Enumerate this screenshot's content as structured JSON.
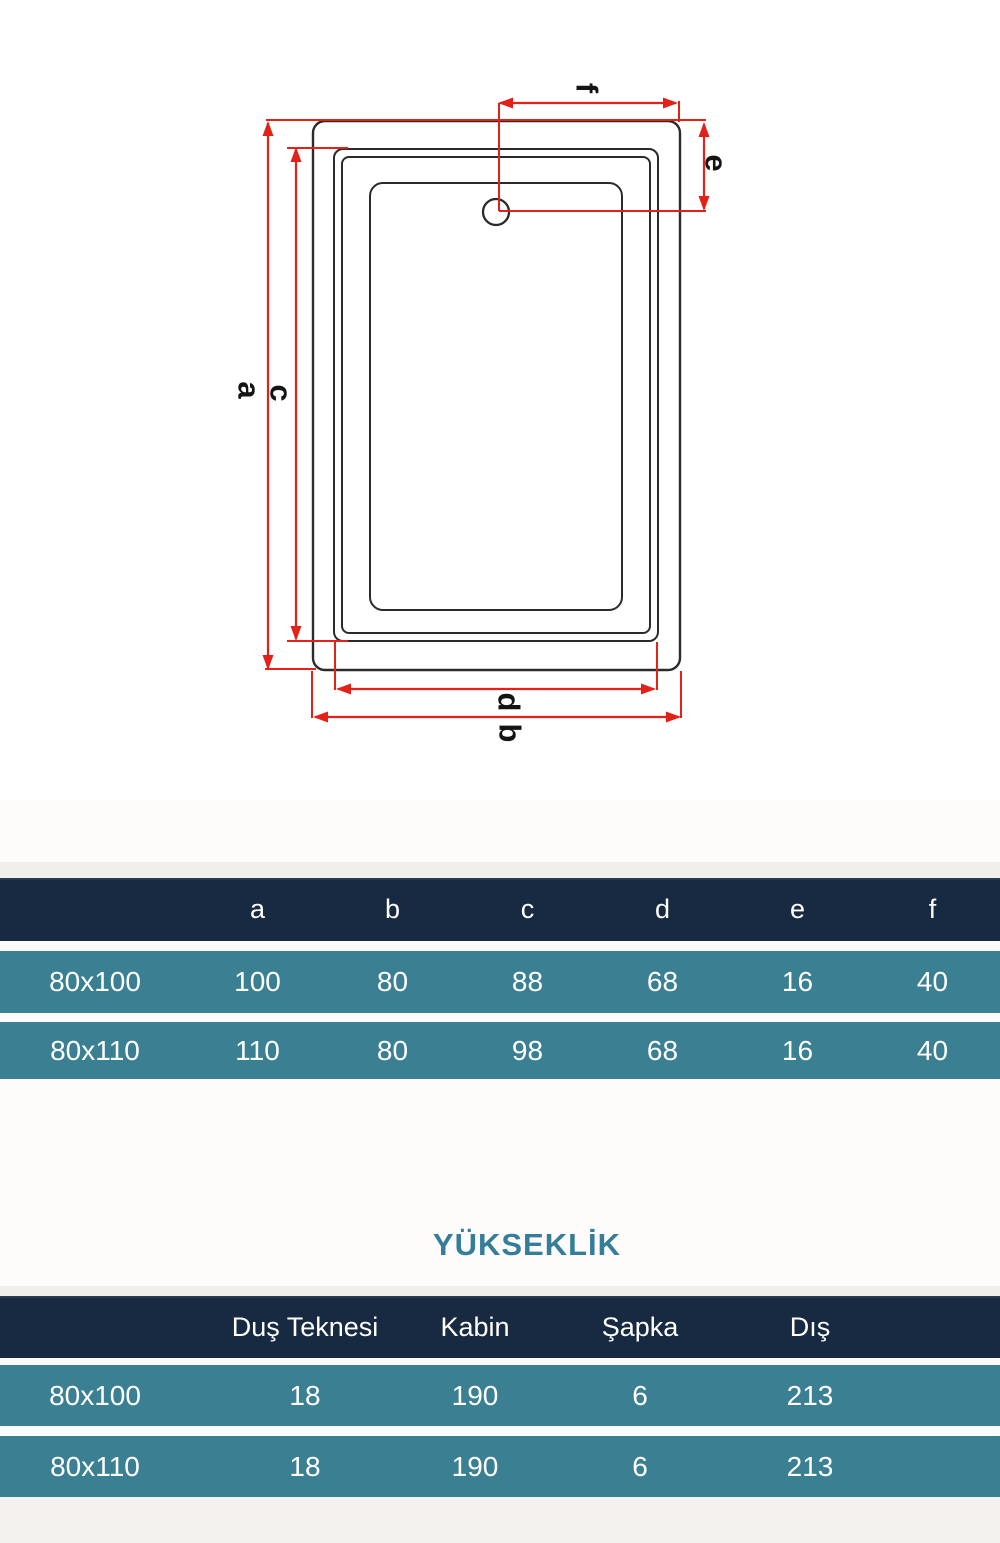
{
  "diagram": {
    "dim_labels": {
      "a": "a",
      "b": "b",
      "c": "c",
      "d": "d",
      "e": "e",
      "f": "f"
    },
    "stroke_color": "#2b2b2b",
    "dimension_color": "#e32119"
  },
  "dim_table": {
    "col_headers": [
      "a",
      "b",
      "c",
      "d",
      "e",
      "f"
    ],
    "rows": [
      {
        "label": "80x100",
        "values": [
          "100",
          "80",
          "88",
          "68",
          "16",
          "40"
        ]
      },
      {
        "label": "80x110",
        "values": [
          "110",
          "80",
          "98",
          "68",
          "16",
          "40"
        ]
      }
    ]
  },
  "height_section": {
    "title": "YÜKSEKLİK",
    "col_headers": [
      "Duş Teknesi",
      "Kabin",
      "Şapka",
      "Dış"
    ],
    "rows": [
      {
        "label": "80x100",
        "values": [
          "18",
          "190",
          "6",
          "213"
        ]
      },
      {
        "label": "80x110",
        "values": [
          "18",
          "190",
          "6",
          "213"
        ]
      }
    ]
  },
  "colors": {
    "header_bg": "#172a42",
    "row_bg": "#3a7f92",
    "title_text": "#347e99",
    "table_text": "#ffffff",
    "dimension_red": "#e32119",
    "page_bg": "#fdfcfa"
  }
}
